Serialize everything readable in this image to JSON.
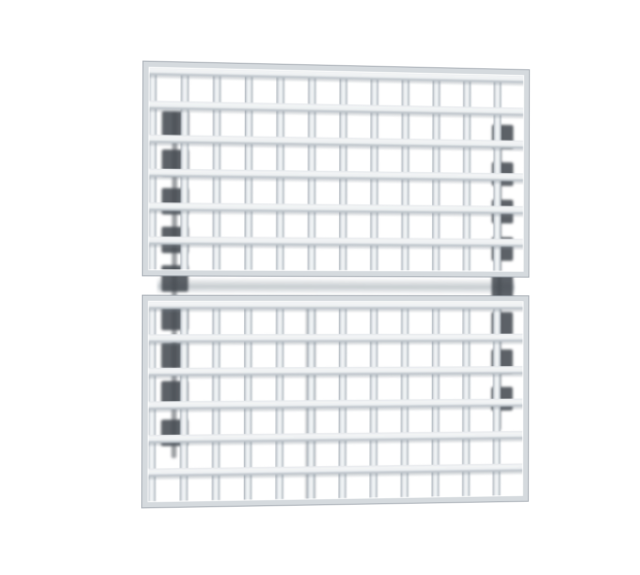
{
  "meta": {
    "background_color": "#ffffff",
    "description": "Product photograph of two stacked silver wire-grid rack panels with square openings on a plain white background. No text, labels, or UI controls are visible in the image."
  },
  "photo": {
    "alt_text": "Two stacked silver wire grid panels with square openings, photographed at a slight angle, with dark shadowed ladder rails along the left and right sides",
    "geometry": {
      "left": 146,
      "top": 66,
      "width": 386,
      "height": 438,
      "seam_gap": 20
    },
    "panels": [
      {
        "name": "top",
        "rows": 6,
        "cols": 12,
        "height": 210
      },
      {
        "name": "bottom",
        "rows": 6,
        "cols": 12,
        "height": 208
      }
    ],
    "colors": {
      "bar_edge": "#9ba3ab",
      "bar_mid": "#c9cfd5",
      "bar_highlight": "#eff2f4",
      "bar_shade": "#bfc6cc",
      "rail_top": "#e3e7ea",
      "under_shadow": "rgba(125,135,145,0.30)",
      "frame": "#d5dade",
      "frame_edge": "rgba(150,158,166,0.8)",
      "seam_shadow": "rgba(150,160,168,0.55)",
      "ladder_dark": "#454b52",
      "ladder_rail": "rgba(72,78,86,0.55)",
      "accent_bar": "rgba(100,108,116,0.38)"
    },
    "ladders": {
      "left": {
        "x": 16,
        "y": 48,
        "width": 34,
        "height": 342,
        "rail_x": 12,
        "rail_width": 5,
        "patch_x": 2,
        "patch_width": 26,
        "patch_height": 26,
        "patch_y": [
          0,
          38,
          76,
          114,
          152,
          190,
          228,
          266,
          304
        ]
      },
      "right": {
        "x": 344,
        "y": 56,
        "width": 28,
        "height": 310,
        "rail_x": 10,
        "rail_width": 4,
        "patch_x": 4,
        "patch_width": 22,
        "patch_height": 24,
        "patch_y": [
          0,
          38,
          76,
          114,
          152,
          190,
          228,
          266
        ]
      }
    },
    "accent_bar": {
      "x": 160,
      "y": 238,
      "width": 10,
      "height": 196
    }
  }
}
